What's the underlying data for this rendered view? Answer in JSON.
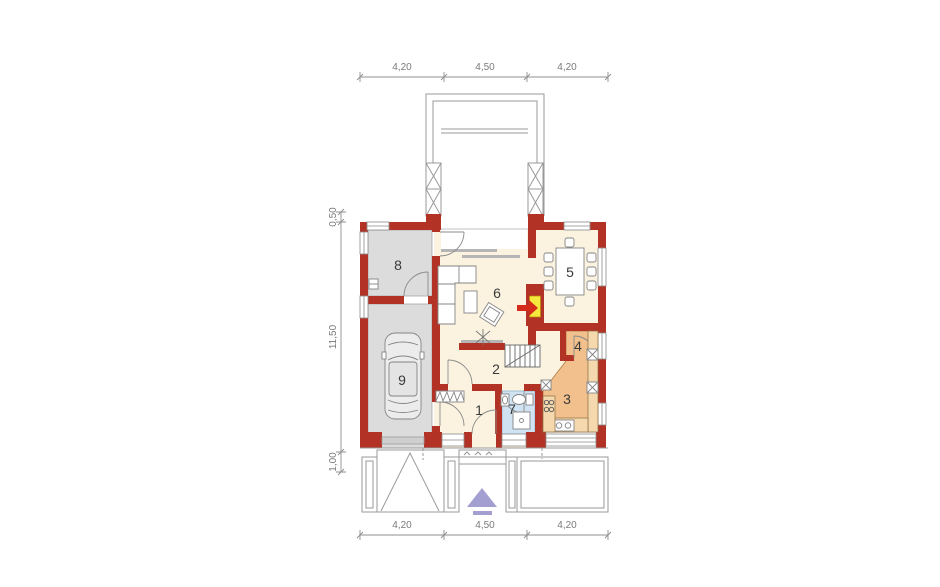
{
  "plan": {
    "type": "floor-plan",
    "dimensions": {
      "top": [
        "4,20",
        "4,50",
        "4,20"
      ],
      "bottom": [
        "4,20",
        "4,50",
        "4,20"
      ],
      "left": [
        "0,50",
        "11,50",
        "1,00"
      ]
    },
    "rooms": [
      {
        "number": "1"
      },
      {
        "number": "2"
      },
      {
        "number": "3"
      },
      {
        "number": "4"
      },
      {
        "number": "5"
      },
      {
        "number": "6"
      },
      {
        "number": "7"
      },
      {
        "number": "8"
      },
      {
        "number": "9"
      }
    ],
    "colors": {
      "wall": "#b23325",
      "floor_main": "#fbf3e0",
      "floor_garage": "#dcdcdc",
      "floor_bathroom": "#cfe3f2",
      "floor_kitchen": "#f1c08c",
      "counter": "#f6d8ae",
      "fireplace": "#f6e93d",
      "fireplace_arrow": "#d42b1a",
      "entrance_arrow": "#a39fd1",
      "lines": "#8a8a8a"
    }
  }
}
